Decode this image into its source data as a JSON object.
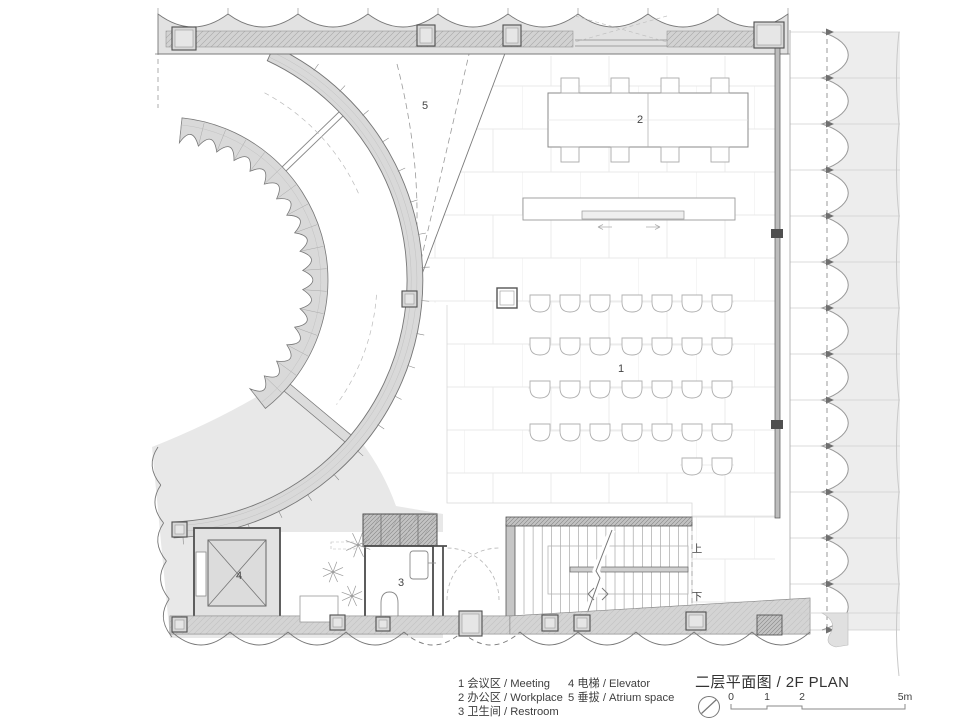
{
  "title_block": {
    "title": "二层平面图 / 2F PLAN"
  },
  "legend": {
    "column1": [
      "1  会议区 / Meeting",
      "2  办公区 / Workplace",
      "3  卫生间 / Restroom"
    ],
    "column2": [
      "4  电梯 / Elevator",
      "5  垂拔 / Atrium space"
    ]
  },
  "plan_labels": {
    "meeting": "1",
    "workplace": "2",
    "restroom": "3",
    "elevator": "4",
    "atrium": "5"
  },
  "stair_labels": {
    "up": "上",
    "down": "下"
  },
  "scale_bar": {
    "ticks": [
      "0",
      "1",
      "2",
      "5m"
    ]
  },
  "colors": {
    "background": "#ffffff",
    "wall_fill": "#dcdcdc",
    "wall_hatch": "#c9c9c9",
    "line_dark": "#4f4f4f",
    "line_mid": "#8a8a8a",
    "tile_line": "#e9e9e9",
    "text": "#3b3b3b"
  }
}
